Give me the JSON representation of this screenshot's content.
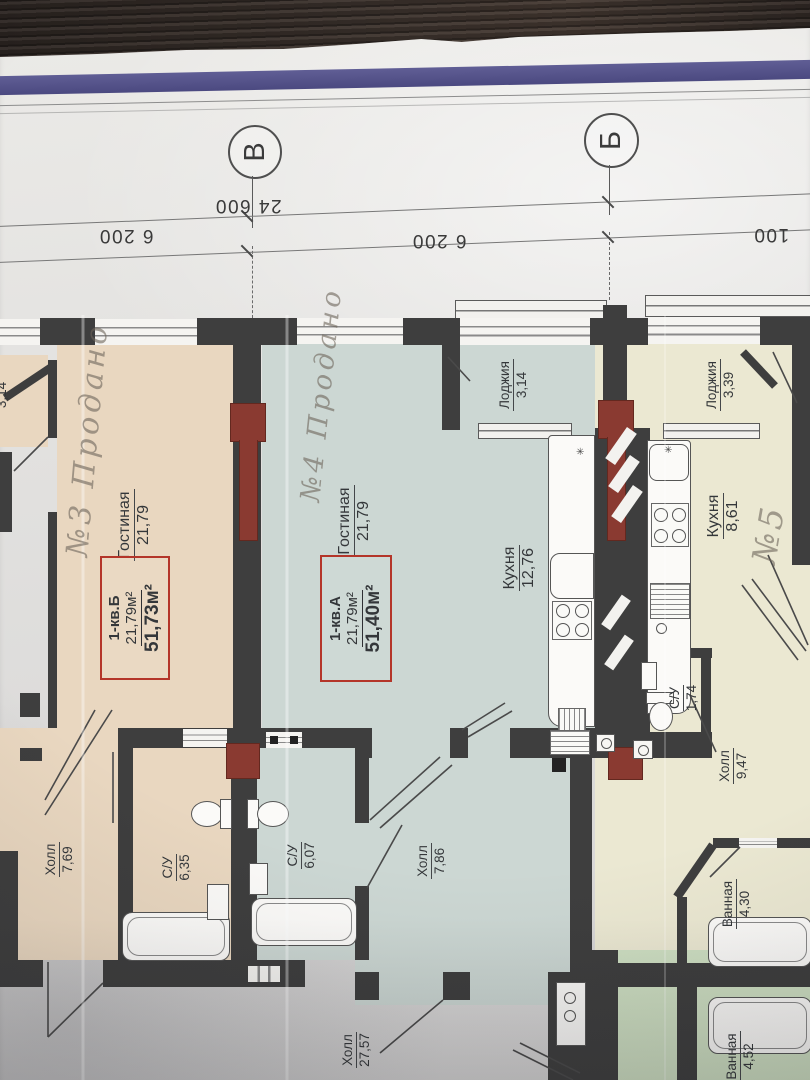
{
  "meta": {
    "description": "Photo of an architectural floor plan sheet (apartment block storey plan) lying on a dark wooden table, plan rotated 90° CCW"
  },
  "grid": {
    "bubble_v": "В",
    "bubble_b": "Б",
    "dim_left": "6 200",
    "dim_total": "24 600",
    "dim_mid": "6 200",
    "dim_right": "100"
  },
  "units": {
    "b": {
      "unit": "1-кв.Б",
      "living": "21,79м²",
      "total": "51,73м²"
    },
    "a": {
      "unit": "1-кв.А",
      "living": "21,79м²",
      "total": "51,40м²"
    }
  },
  "notes": {
    "b": "№3 Продано",
    "a": "№4 Продано",
    "k5": "№5"
  },
  "rooms": {
    "b_gost": {
      "name": "Гостиная",
      "area": "21,79"
    },
    "b_hall": {
      "name": "Холл",
      "area": "7,69"
    },
    "b_su": {
      "name": "С/У",
      "area": "6,35"
    },
    "a_gost": {
      "name": "Гостиная",
      "area": "21,79"
    },
    "a_kitchen": {
      "name": "Кухня",
      "area": "12,76"
    },
    "a_loggia": {
      "name": "Лоджия",
      "area": "3,14"
    },
    "a_su": {
      "name": "С/У",
      "area": "6,07"
    },
    "a_hall": {
      "name": "Холл",
      "area": "7,86"
    },
    "k5_kitchen": {
      "name": "Кухня",
      "area": "8,61"
    },
    "k5_loggia": {
      "name": "Лоджия",
      "area": "3,39"
    },
    "k5_su": {
      "name": "С/У",
      "area": "1,74"
    },
    "k5_hall": {
      "name": "Холл",
      "area": "9,47"
    },
    "k5_bath": {
      "name": "Ванная",
      "area": "4,30"
    },
    "common_hall": {
      "name": "Холл",
      "area": "27,57"
    },
    "bath452": {
      "name": "Ванная",
      "area": "4,52"
    },
    "neighbor_loggia": {
      "area": "3,14"
    }
  },
  "icons": {
    "vent_mark": "✳"
  },
  "colors": {
    "apt_b_fill": "#e9d7c0",
    "apt_a_fill": "#ccd7d3",
    "apt_5_fill": "#ebe8d2",
    "green_fill": "#cfe0c3",
    "wall": "#3e3e3e",
    "column_red": "#8a3a31",
    "unit_box_red": "#b43529",
    "stripe_blue": "#524f88",
    "paper": "#e2e1df",
    "wood": "#3a312c"
  }
}
